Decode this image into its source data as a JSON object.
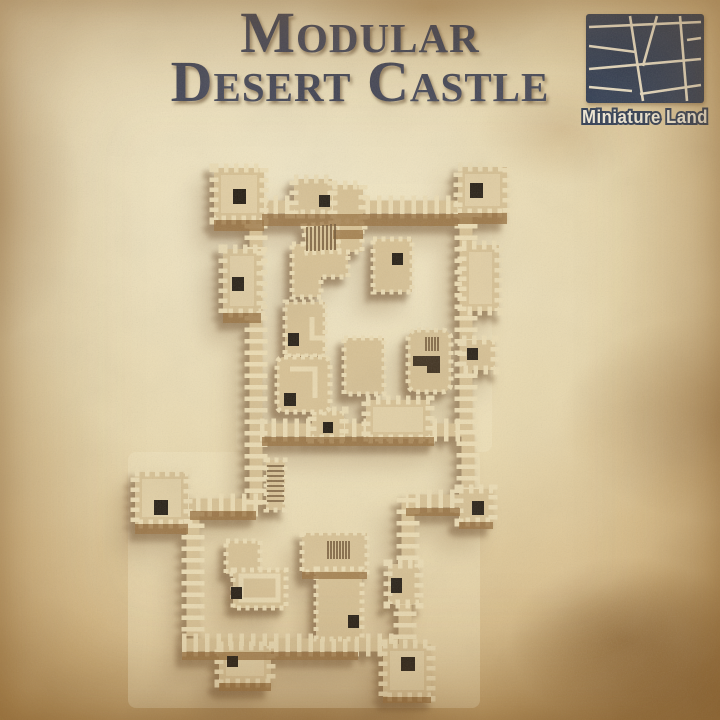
{
  "title": {
    "line1": "Modular",
    "line2": "Desert Castle"
  },
  "brand": {
    "name": "Miniature Land"
  },
  "product": {
    "render_alt": "Top-down render of a modular desert castle miniature terrain set"
  },
  "palette": {
    "title-color": "#3e4254",
    "logo-bg": "#2b3951",
    "logo-line": "#efe5cb",
    "logo-text": "#f6efdb",
    "parch-light": "#f2e8c8",
    "parch-mid": "#e9d8ac",
    "parch-dark": "#d8bb86",
    "parch-edge": "#b18a4e",
    "wall-light": "#ecdcb2",
    "wall-mid": "#d8c192",
    "wall-dark": "#b99a67",
    "wall-face": "#9a723e",
    "floor": "#f3e7c0",
    "window": "#221a0f",
    "shadow": "#75502a"
  }
}
